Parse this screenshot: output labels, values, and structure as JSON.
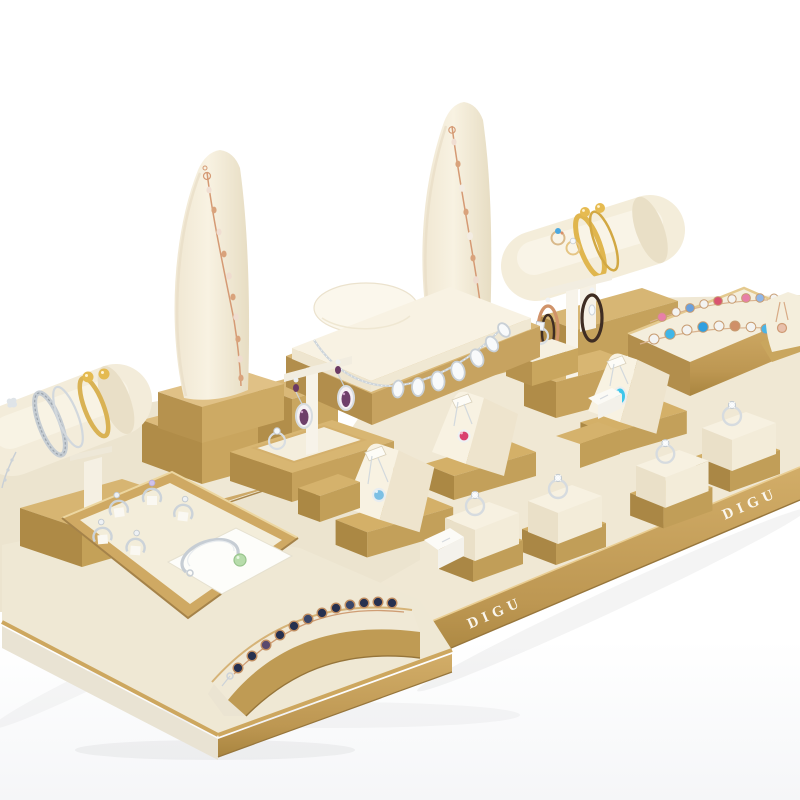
{
  "brand": {
    "name": "DIGU"
  },
  "scene": {
    "type": "product-photograph",
    "subject": "Gold and ivory jewelry display prop set with jewelry",
    "background": "#ffffff",
    "palette": {
      "gold": "#c8a45e",
      "gold_dark": "#ab8745",
      "gold_light": "#ddbc7e",
      "cream": "#f4eedd",
      "ivory_shadow": "#eae0c8",
      "silver": "#ccd3d9",
      "rose_gold": "#d49a74",
      "stone_blue": "#7cc0e4",
      "stone_aqua": "#3ec6ea",
      "stone_red": "#d94070",
      "stone_purple": "#6f3f6a",
      "stone_navy": "#26304f",
      "stone_green": "#b7dcab"
    },
    "items": [
      {
        "name": "tall-necklace-stand-left",
        "jewelry": "rose-gold chain bracelet"
      },
      {
        "name": "tall-necklace-stand-center",
        "jewelry": "rose-gold gemstone bracelet"
      },
      {
        "name": "bracelet-bar-right",
        "jewelry": "gold bangles and rings"
      },
      {
        "name": "bracelet-bar-left",
        "jewelry": "silver and gold bangles"
      },
      {
        "name": "necklace-bust-display",
        "jewelry": "silver crystal necklace"
      },
      {
        "name": "earring-t-stand-center",
        "jewelry": "amethyst drop earrings"
      },
      {
        "name": "earring-t-stand-right",
        "jewelry": "rose-gold hoop earrings"
      },
      {
        "name": "bracelet-box-top-right",
        "jewelry": "two multicolor gemstone bracelets"
      },
      {
        "name": "pendant-wedge-blue",
        "jewelry": "blue crystal pendant necklace"
      },
      {
        "name": "pendant-wedge-red",
        "jewelry": "red crystal pendant necklace"
      },
      {
        "name": "pendant-wedge-aqua",
        "jewelry": "aqua teardrop pendant necklace"
      },
      {
        "name": "ring-cube-1",
        "jewelry": "solitaire ring"
      },
      {
        "name": "ring-cube-2",
        "jewelry": "solitaire ring"
      },
      {
        "name": "ring-cube-3",
        "jewelry": "solitaire ring"
      },
      {
        "name": "ring-cube-4",
        "jewelry": "solitaire ring"
      },
      {
        "name": "ring-tray",
        "jewelry": "five silver rings and a cuff bangle with green stone"
      },
      {
        "name": "bracelet-ramp",
        "jewelry": "sapphire-tone tennis bracelet"
      }
    ]
  }
}
